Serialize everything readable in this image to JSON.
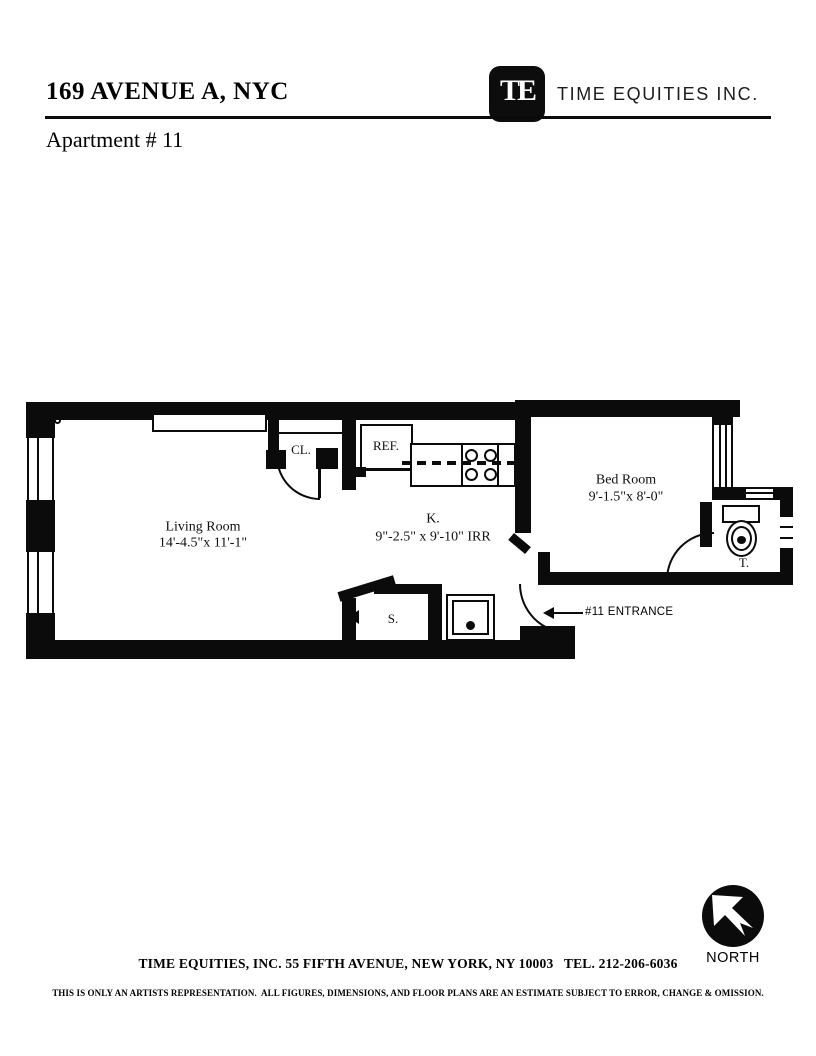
{
  "header": {
    "address": "169 AVENUE A, NYC",
    "apartment_line": "Apartment # 11",
    "brand_name": "TIME EQUITIES INC.",
    "logo_monogram": "TE"
  },
  "plan": {
    "living_room": {
      "name": "Living Room",
      "dims": "14'-4.5\"x 11'-1\""
    },
    "kitchen": {
      "name": "K.",
      "dims": "9\"-2.5\" x 9'-10\" IRR"
    },
    "bedroom": {
      "name": "Bed Room",
      "dims": "9'-1.5\"x 8'-0\""
    },
    "closet_label": "CL.",
    "refrigerator_label": "REF.",
    "toilet_label": "T.",
    "shower_label": "S.",
    "entrance_label": "#11 ENTRANCE"
  },
  "footer": {
    "contact_line": "TIME EQUITIES, INC. 55 FIFTH AVENUE, NEW YORK, NY 10003   TEL. 212-206-6036",
    "disclaimer": "THIS IS ONLY AN ARTISTS REPRESENTATION.  ALL FIGURES, DIMENSIONS, AND FLOOR PLANS ARE AN ESTIMATE SUBJECT TO ERROR, CHANGE & OMISSION.",
    "compass_label": "NORTH"
  },
  "colors": {
    "ink": "#0b0b0b",
    "paper": "#ffffff"
  }
}
